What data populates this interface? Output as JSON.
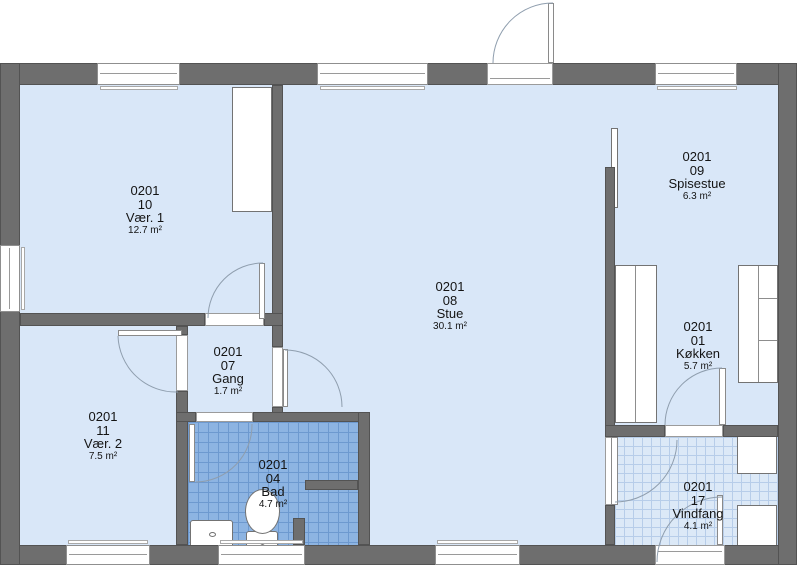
{
  "plan": {
    "building_code": "0201",
    "rooms": [
      {
        "code": "0201",
        "number": "10",
        "name": "Vær. 1",
        "area": "12.7 m²"
      },
      {
        "code": "0201",
        "number": "08",
        "name": "Stue",
        "area": "30.1 m²"
      },
      {
        "code": "0201",
        "number": "09",
        "name": "Spisestue",
        "area": "6.3 m²"
      },
      {
        "code": "0201",
        "number": "01",
        "name": "Køkken",
        "area": "5.7 m²"
      },
      {
        "code": "0201",
        "number": "07",
        "name": "Gang",
        "area": "1.7 m²"
      },
      {
        "code": "0201",
        "number": "11",
        "name": "Vær. 2",
        "area": "7.5 m²"
      },
      {
        "code": "0201",
        "number": "04",
        "name": "Bad",
        "area": "4.7 m²"
      },
      {
        "code": "0201",
        "number": "17",
        "name": "Vindfang",
        "area": "4.1 m²"
      }
    ],
    "colors": {
      "wall": "#6e6e6e",
      "room_fill": "#d9e7f8",
      "bathroom_tile": "#8db4e2",
      "bathroom_tile_line": "#6d99cf",
      "vindfang_tile": "#dce9f7",
      "vindfang_tile_line": "#b7cde9"
    }
  }
}
